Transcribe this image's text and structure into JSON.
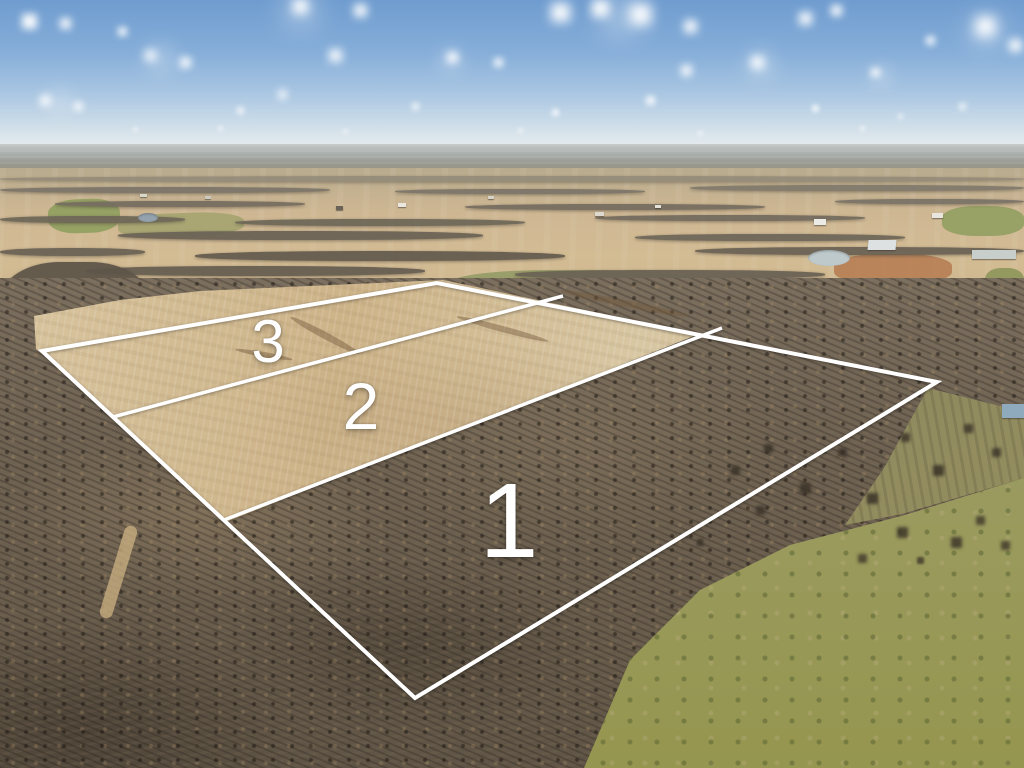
{
  "photo": {
    "kind": "aerial-drone-photo",
    "subject": "rural acreage with surveyed lot overlay"
  },
  "overlay": {
    "line_color": "#ffffff",
    "label_color": "#ffffff",
    "outer_boundary": [
      [
        42,
        351
      ],
      [
        437,
        283
      ],
      [
        937,
        382
      ],
      [
        415,
        698
      ]
    ],
    "dividers": [
      [
        [
          113,
          417
        ],
        [
          563,
          296
        ]
      ],
      [
        [
          224,
          520
        ],
        [
          722,
          328
        ]
      ]
    ],
    "lots": [
      {
        "label": "1"
      },
      {
        "label": "2"
      },
      {
        "label": "3"
      }
    ]
  },
  "palette": {
    "sky_top": "#6f9ccf",
    "sky_horizon": "#e9eef1",
    "field_tan": "#cdb388",
    "woods_brown": "#685c4c",
    "pasture_green": "#9d9d68",
    "boundary_white": "#ffffff"
  }
}
